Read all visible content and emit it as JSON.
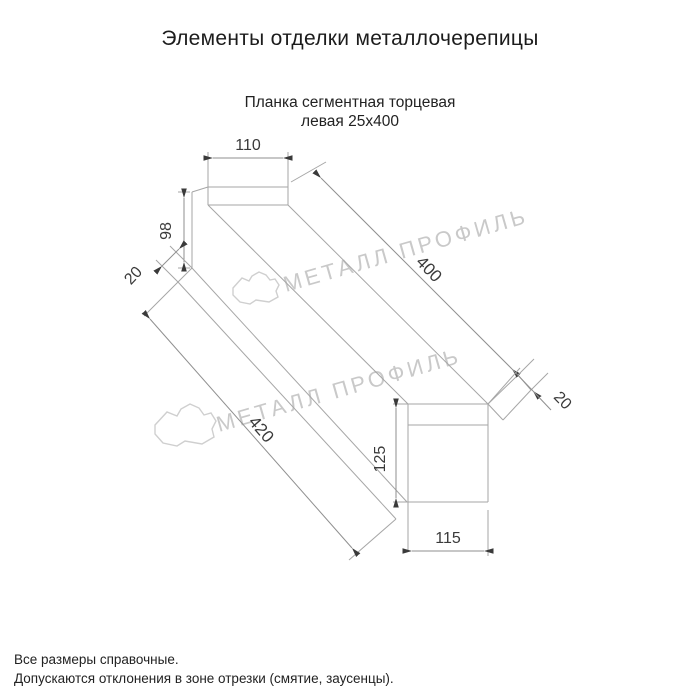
{
  "page": {
    "title": "Элементы отделки металлочерепицы",
    "product_name_line1": "Планка сегментная торцевая",
    "product_name_line2": "левая 25х400",
    "footer_line1": "Все размеры справочные.",
    "footer_line2": "Допускаются отклонения в зоне отрезки (смятие, заусенцы)."
  },
  "drawing": {
    "dimensions": {
      "top_flange_width": "110",
      "left_end_height": "98",
      "left_hem": "20",
      "top_edge_length": "400",
      "right_hem": "20",
      "bottom_edge_length": "420",
      "right_end_height": "125",
      "bottom_flange_width": "115"
    },
    "watermark_text": "МЕТАЛЛ ПРОФИЛЬ"
  },
  "colors": {
    "background": "#ffffff",
    "drawing_line": "#a6a6a6",
    "dimension_text": "#3a3a3a",
    "heading_text": "#1c1c1c",
    "watermark": "#c9c9c9"
  }
}
